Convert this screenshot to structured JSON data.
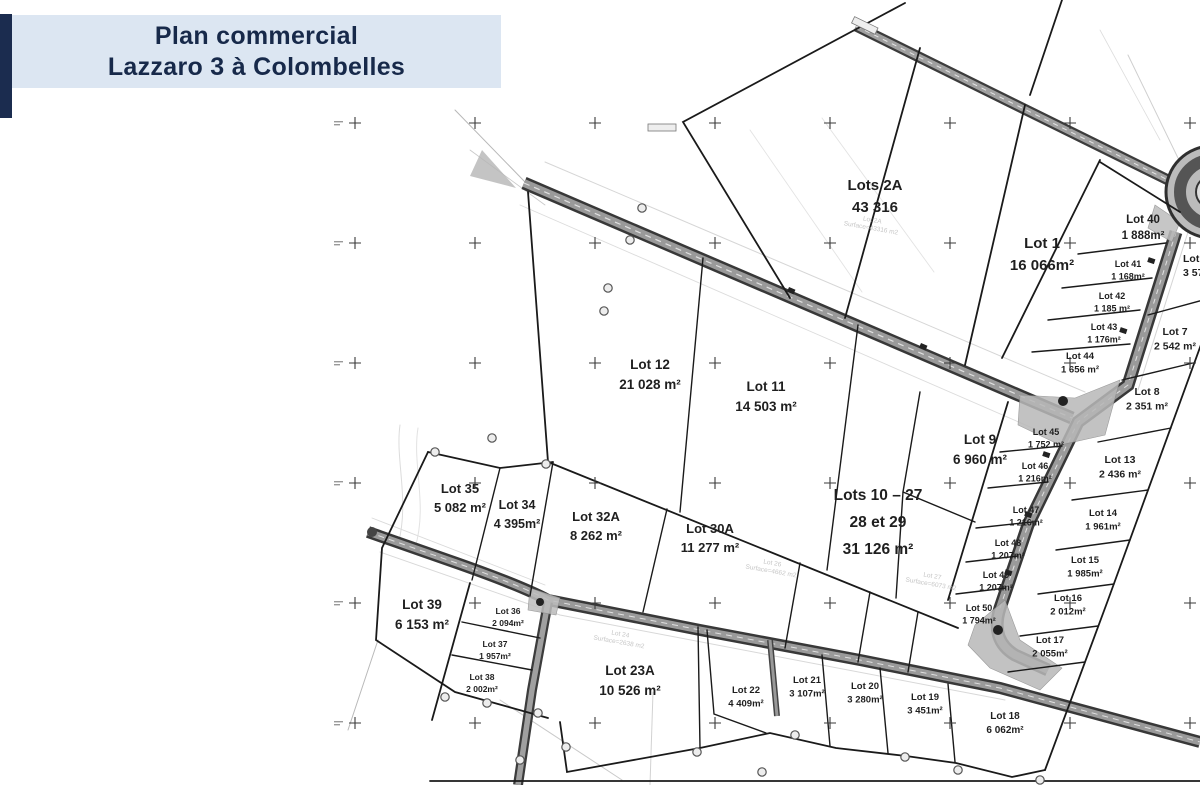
{
  "title": {
    "line1": "Plan commercial",
    "line2": "Lazzaro 3 à Colombelles"
  },
  "colors": {
    "accent_navy": "#1b2c4f",
    "title_bg": "#dce6f2",
    "title_text": "#17294a",
    "road_dark": "#3a3a3a",
    "road_mid": "#9a9a9a",
    "boundary": "#1a1a1a",
    "underlay_grey": "#c6c6c6"
  },
  "map": {
    "lots": [
      {
        "id": "lots-2a",
        "lines": [
          "Lots 2A",
          "43 316"
        ],
        "x": 875,
        "y": 190,
        "fs": 15,
        "dy": 22
      },
      {
        "id": "lot-1",
        "lines": [
          "Lot 1",
          "16 066m²"
        ],
        "x": 1042,
        "y": 248,
        "fs": 15,
        "dy": 22
      },
      {
        "id": "lot-12",
        "lines": [
          "Lot 12",
          "21 028 m²"
        ],
        "x": 650,
        "y": 369,
        "fs": 13.5,
        "dy": 20
      },
      {
        "id": "lot-11",
        "lines": [
          "Lot 11",
          "14 503 m²"
        ],
        "x": 766,
        "y": 391,
        "fs": 13.5,
        "dy": 20
      },
      {
        "id": "lot-9",
        "lines": [
          "Lot 9",
          "6 960 m²"
        ],
        "x": 980,
        "y": 444,
        "fs": 13.5,
        "dy": 20
      },
      {
        "id": "lots-10-27",
        "lines": [
          "Lots 10 – 27",
          "28 et 29",
          "31 126 m²"
        ],
        "x": 878,
        "y": 500,
        "fs": 15.5,
        "dy": 27
      },
      {
        "id": "lot-35",
        "lines": [
          "Lot 35",
          "5 082 m²"
        ],
        "x": 460,
        "y": 493,
        "fs": 13,
        "dy": 19
      },
      {
        "id": "lot-34",
        "lines": [
          "Lot 34",
          "4 395m²"
        ],
        "x": 517,
        "y": 509,
        "fs": 12.5,
        "dy": 19
      },
      {
        "id": "lot-32a",
        "lines": [
          "Lot 32A",
          "8 262 m²"
        ],
        "x": 596,
        "y": 521,
        "fs": 13,
        "dy": 19
      },
      {
        "id": "lot-30a",
        "lines": [
          "Lot 30A",
          "11 277 m²"
        ],
        "x": 710,
        "y": 533,
        "fs": 13,
        "dy": 19
      },
      {
        "id": "lot-39",
        "lines": [
          "Lot 39",
          "6 153 m²"
        ],
        "x": 422,
        "y": 609,
        "fs": 13.5,
        "dy": 20
      },
      {
        "id": "lot-36",
        "lines": [
          "Lot 36",
          "2 094m²"
        ],
        "x": 508,
        "y": 614,
        "fs": 8.5,
        "dy": 12
      },
      {
        "id": "lot-37",
        "lines": [
          "Lot 37",
          "1 957m²"
        ],
        "x": 495,
        "y": 647,
        "fs": 8.5,
        "dy": 12
      },
      {
        "id": "lot-38",
        "lines": [
          "Lot 38",
          "2 002m²"
        ],
        "x": 482,
        "y": 680,
        "fs": 8.5,
        "dy": 12
      },
      {
        "id": "lot-23a",
        "lines": [
          "Lot 23A",
          "10 526 m²"
        ],
        "x": 630,
        "y": 675,
        "fs": 13.5,
        "dy": 20
      },
      {
        "id": "lot-22",
        "lines": [
          "Lot 22",
          "4 409m²"
        ],
        "x": 746,
        "y": 693,
        "fs": 9.5,
        "dy": 13.5
      },
      {
        "id": "lot-21",
        "lines": [
          "Lot 21",
          "3 107m²"
        ],
        "x": 807,
        "y": 683,
        "fs": 9.5,
        "dy": 13.5
      },
      {
        "id": "lot-20",
        "lines": [
          "Lot 20",
          "3 280m²"
        ],
        "x": 865,
        "y": 689,
        "fs": 9.5,
        "dy": 13.5
      },
      {
        "id": "lot-19",
        "lines": [
          "Lot 19",
          "3 451m²"
        ],
        "x": 925,
        "y": 700,
        "fs": 9.5,
        "dy": 13.5
      },
      {
        "id": "lot-18",
        "lines": [
          "Lot 18",
          "6 062m²"
        ],
        "x": 1005,
        "y": 719,
        "fs": 10,
        "dy": 14
      },
      {
        "id": "lot-40",
        "lines": [
          "Lot 40",
          "1 888m²"
        ],
        "x": 1143,
        "y": 223,
        "fs": 11.5,
        "dy": 16
      },
      {
        "id": "lot-41",
        "lines": [
          "Lot 41",
          "1 168m²"
        ],
        "x": 1128,
        "y": 267,
        "fs": 9,
        "dy": 12.5
      },
      {
        "id": "lot-42",
        "lines": [
          "Lot 42",
          "1 185 m²"
        ],
        "x": 1112,
        "y": 299,
        "fs": 9,
        "dy": 12.5
      },
      {
        "id": "lot-43",
        "lines": [
          "Lot 43",
          "1 176m²"
        ],
        "x": 1104,
        "y": 330,
        "fs": 9,
        "dy": 12.5
      },
      {
        "id": "lot-44",
        "lines": [
          "Lot 44",
          "1 656 m²"
        ],
        "x": 1080,
        "y": 359,
        "fs": 9.5,
        "dy": 13.5
      },
      {
        "id": "lot-45",
        "lines": [
          "Lot 45",
          "1 752 m²"
        ],
        "x": 1046,
        "y": 435,
        "fs": 9,
        "dy": 12.5
      },
      {
        "id": "lot-46",
        "lines": [
          "Lot 46",
          "1 216m²"
        ],
        "x": 1035,
        "y": 469,
        "fs": 9,
        "dy": 12.5
      },
      {
        "id": "lot-47",
        "lines": [
          "Lot 47",
          "1 216m²"
        ],
        "x": 1026,
        "y": 513,
        "fs": 9,
        "dy": 12.5
      },
      {
        "id": "lot-48",
        "lines": [
          "Lot 48",
          "1 207m²"
        ],
        "x": 1008,
        "y": 546,
        "fs": 9,
        "dy": 12.5
      },
      {
        "id": "lot-49",
        "lines": [
          "Lot 49",
          "1 207m²"
        ],
        "x": 996,
        "y": 578,
        "fs": 9,
        "dy": 12.5
      },
      {
        "id": "lot-50",
        "lines": [
          "Lot 50",
          "1 794m²"
        ],
        "x": 979,
        "y": 611,
        "fs": 9,
        "dy": 12.5
      },
      {
        "id": "lot-7",
        "lines": [
          "Lot 7",
          "2 542 m²"
        ],
        "x": 1175,
        "y": 335,
        "fs": 10.5,
        "dy": 14.5
      },
      {
        "id": "lot-8",
        "lines": [
          "Lot 8",
          "2 351 m²"
        ],
        "x": 1147,
        "y": 395,
        "fs": 10.5,
        "dy": 14.5
      },
      {
        "id": "lot-13",
        "lines": [
          "Lot 13",
          "2 436 m²"
        ],
        "x": 1120,
        "y": 463,
        "fs": 10.5,
        "dy": 14.5
      },
      {
        "id": "lot-14",
        "lines": [
          "Lot 14",
          "1 961m²"
        ],
        "x": 1103,
        "y": 516,
        "fs": 9.5,
        "dy": 13.5
      },
      {
        "id": "lot-15",
        "lines": [
          "Lot 15",
          "1 985m²"
        ],
        "x": 1085,
        "y": 563,
        "fs": 9.5,
        "dy": 13.5
      },
      {
        "id": "lot-16",
        "lines": [
          "Lot 16",
          "2 012m²"
        ],
        "x": 1068,
        "y": 601,
        "fs": 9.5,
        "dy": 13.5
      },
      {
        "id": "lot-17",
        "lines": [
          "Lot 17",
          "2 055m²"
        ],
        "x": 1050,
        "y": 643,
        "fs": 9.5,
        "dy": 13.5
      },
      {
        "id": "lot-edge-partial",
        "lines": [
          "Lot",
          "3 57"
        ],
        "x": 1183,
        "y": 262,
        "fs": 10.5,
        "dy": 14,
        "anchor": "start"
      }
    ],
    "underlay_labels": [
      {
        "lines": [
          "Lot 2A",
          "Surface=43316 m2"
        ],
        "x": 872,
        "y": 222,
        "rot": 10
      },
      {
        "lines": [
          "Lot 24",
          "Surface=2638 m2"
        ],
        "x": 620,
        "y": 636,
        "rot": 10
      },
      {
        "lines": [
          "Lot 26",
          "Surface=4662 m2"
        ],
        "x": 772,
        "y": 565,
        "rot": 10
      },
      {
        "lines": [
          "Lot 27",
          "Surface=6073 m2"
        ],
        "x": 932,
        "y": 578,
        "rot": 10
      }
    ]
  }
}
